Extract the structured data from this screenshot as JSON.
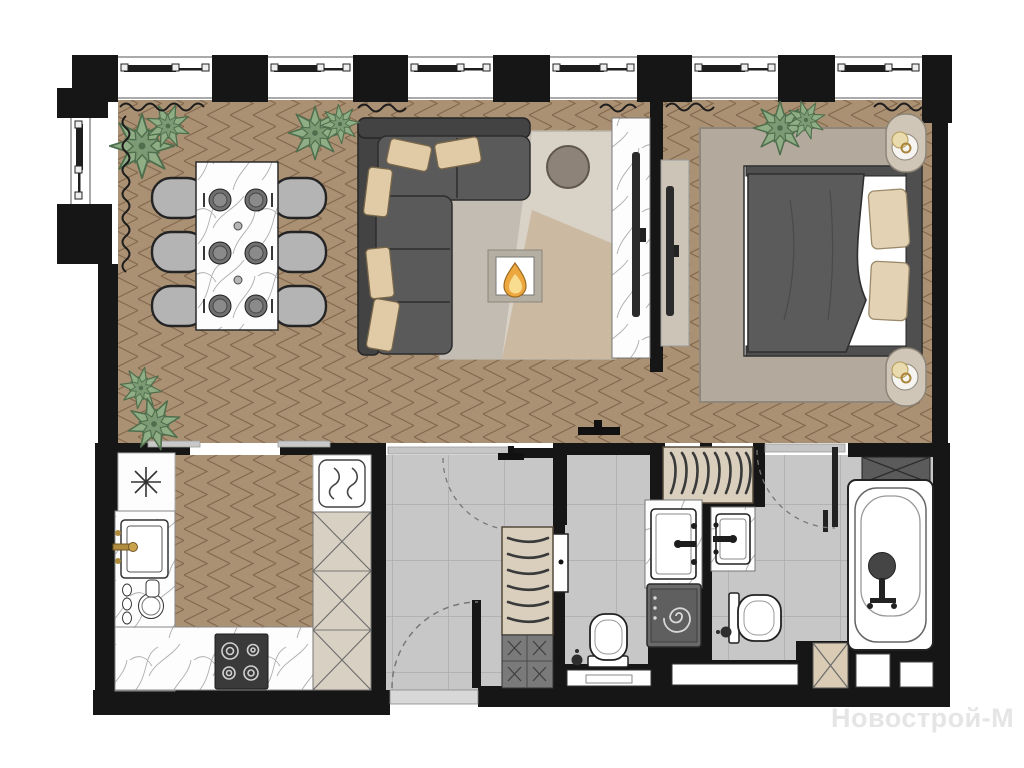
{
  "watermark": {
    "text": "Новострой-М",
    "color": "#e5e5e5"
  },
  "plan": {
    "kind": "apartment floor plan",
    "view": "top-down furnished render",
    "text_labels_on_plan": "none"
  },
  "palette": {
    "wall": "#161616",
    "wood_floor": "#ab9173",
    "wood_line": "#83684e",
    "tile_floor": "#c7c7c7",
    "tile_line": "#a6a6a6",
    "marble": "#fdfdfd",
    "sofa": "#5a5a5a",
    "cushion": "#e0cba6",
    "plant": "#8fae85",
    "rug_living": "#d9d2c7",
    "rug_bedroom": "#b3a99d",
    "bed_duvet": "#5b5b5b",
    "flame_outer": "#eda73f",
    "flame_inner": "#f8dc90",
    "gold_faucet": "#b08d3e",
    "wardrobe": "#d9cfbc",
    "appliance": "#6a6a6a"
  },
  "windows": {
    "top_wall_count": 6,
    "left_wall_count": 1
  },
  "rooms": [
    {
      "id": "dining-living",
      "label": "open dining / living area",
      "floor": "herringbone wood"
    },
    {
      "id": "bedroom",
      "label": "bedroom",
      "floor": "herringbone wood"
    },
    {
      "id": "kitchen",
      "label": "kitchen",
      "floor": "herringbone wood"
    },
    {
      "id": "hallway",
      "label": "entrance hall",
      "floor": "gray tile"
    },
    {
      "id": "bathroom-guest",
      "label": "guest bathroom",
      "floor": "gray tile"
    },
    {
      "id": "bathroom-master",
      "label": "master bathroom",
      "floor": "gray tile"
    }
  ],
  "furniture": {
    "dining": [
      "marble dining table with 6 place settings",
      "6 gray chairs",
      "potted plants"
    ],
    "living": [
      "L-shaped dark sofa with cushions",
      "round coffee table",
      "patchwork rug",
      "fireplace with flame symbol",
      "TV on marble accent panel"
    ],
    "bedroom": [
      "double bed with duvet and 2 pillows",
      "2 oval nightstands with lamps",
      "large rug",
      "TV panel",
      "built-in closet with hangers",
      "plant"
    ],
    "kitchen": [
      "counter with star symbol",
      "sink with gold faucet",
      "dish rack",
      "4-burner stove",
      "appliance with wave symbol",
      "tall cabinets marked X"
    ],
    "hallway": [
      "entrance door with swing arc",
      "wardrobe with hangers",
      "shoe cabinet marked X"
    ],
    "bathroom_guest": [
      "washbasin on marble counter",
      "washing machine",
      "toilet with brush"
    ],
    "bathroom_master": [
      "washbasin on marble counter",
      "toilet with brush",
      "bathtub with dark fittings",
      "cabinets marked X",
      "door with swing arc"
    ]
  }
}
